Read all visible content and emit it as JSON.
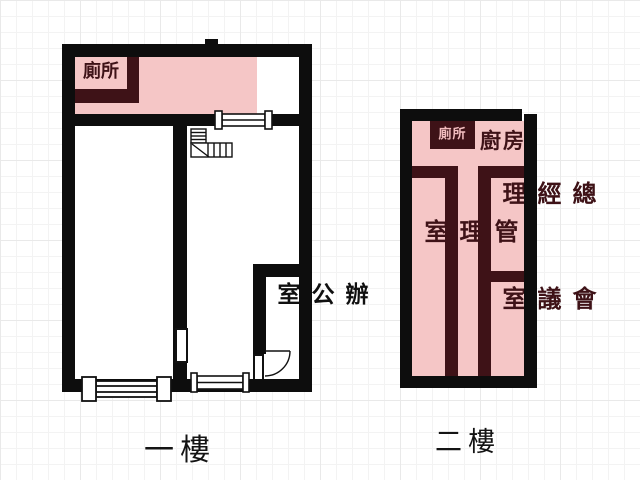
{
  "drawing_type": "floor-plan",
  "colors": {
    "outer_wall": "#0d0d0d",
    "interior_wall": "#3e1217",
    "room_fill": "#f5c6c6",
    "label_on_wall": "#f2bdbf",
    "caption_text": "#141414"
  },
  "floor1": {
    "label": "一樓",
    "rooms": {
      "toilet": {
        "label": "廁所"
      },
      "office": {
        "label": "辦公室"
      }
    }
  },
  "floor2": {
    "label": "二樓",
    "rooms": {
      "toilet": {
        "label": "廁所"
      },
      "kitchen": {
        "label": "廚房"
      },
      "management": {
        "label": "管理室"
      },
      "general_manager": {
        "label": "總經理"
      },
      "meeting": {
        "label": "會議室"
      }
    }
  }
}
